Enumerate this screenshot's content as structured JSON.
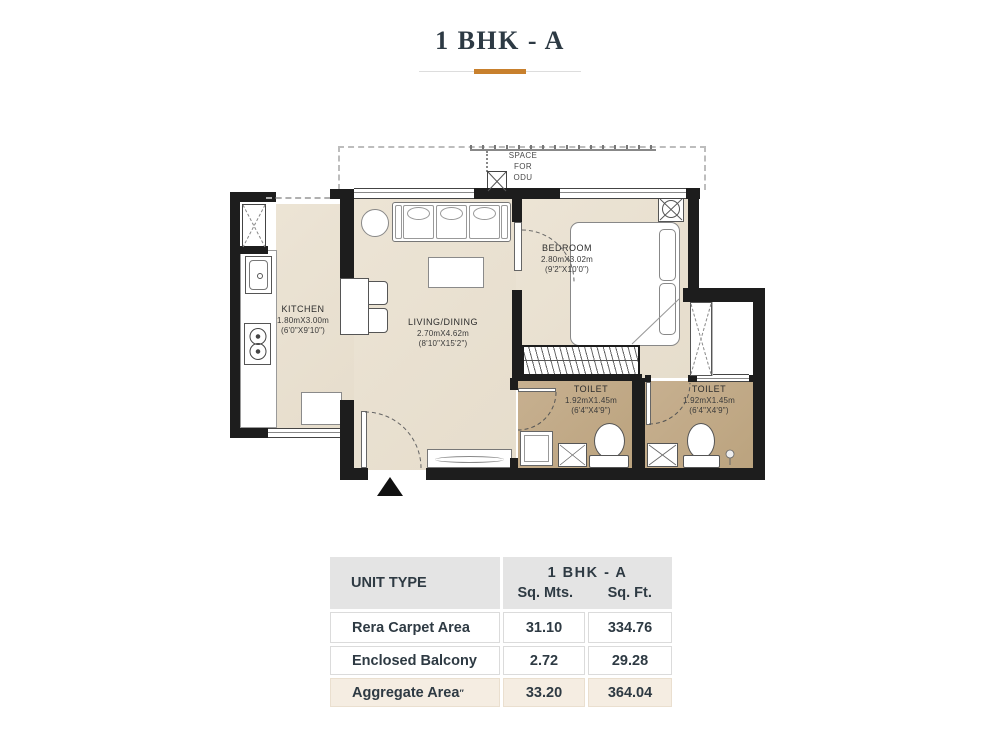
{
  "title": "1 BHK - A",
  "colors": {
    "accent_orange": "#c8802d",
    "wall_black": "#1d1d1d",
    "floor_cream": "#eae2d3",
    "floor_toilet_tan": "#c2aa88",
    "table_header_gray": "#e4e4e4",
    "table_aggregate_cream": "#f5ede2",
    "text_dark": "#2e3a43"
  },
  "plan": {
    "space_for_odu": {
      "line1": "SPACE",
      "line2": "FOR",
      "line3": "ODU"
    },
    "kitchen": {
      "name": "KITCHEN",
      "metric": "1.80mX3.00m",
      "imperial": "(6'0\"X9'10\")"
    },
    "living": {
      "name": "LIVING/DINING",
      "metric": "2.70mX4.62m",
      "imperial": "(8'10\"X15'2\")"
    },
    "bedroom": {
      "name": "BEDROOM",
      "metric": "2.80mX3.02m",
      "imperial": "(9'2\"X10'0\")"
    },
    "toilet1": {
      "name": "TOILET",
      "metric": "1.92mX1.45m",
      "imperial": "(6'4\"X4'9\")"
    },
    "toilet2": {
      "name": "TOILET",
      "metric": "1.92mX1.45m",
      "imperial": "(6'4\"X4'9\")"
    }
  },
  "table": {
    "unit_type_header": "UNIT TYPE",
    "unit_name": "1 BHK - A",
    "col_sqmts": "Sq. Mts.",
    "col_sqft": "Sq. Ft.",
    "rows": [
      {
        "label": "Rera Carpet Area",
        "suffix": "",
        "sqmts": "31.10",
        "sqft": "334.76"
      },
      {
        "label": "Enclosed Balcony",
        "suffix": "",
        "sqmts": "2.72",
        "sqft": "29.28"
      },
      {
        "label": "Aggregate Area",
        "suffix": "″",
        "sqmts": "33.20",
        "sqft": "364.04"
      }
    ]
  }
}
